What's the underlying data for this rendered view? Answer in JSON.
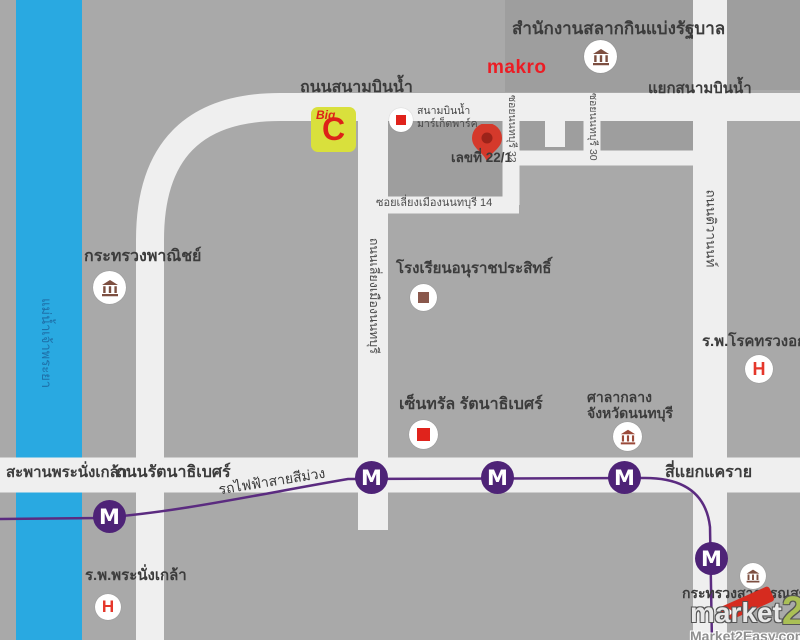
{
  "colors": {
    "background": "#a9a9a9",
    "block": "#9e9e9e",
    "road": "#efefef",
    "river_blue": "#29a9e1",
    "purple_line": "#5b2b80",
    "metro_badge": "#4e2377",
    "marker_red": "#e0231c",
    "icon_brown": "#7d4f41",
    "pin_red": "#d5392b",
    "bigc_yellow": "#d9e03c",
    "makro_red": "#ec1c24",
    "watermark_green": "#aabf55"
  },
  "river": {
    "name": "แม่น้ำเจ้าพระยา"
  },
  "roads": {
    "sanambinnam": "ถนนสนามบินน้ำ",
    "sanambinnam_junction": "แยกสนามบินน้ำ",
    "bypass": "ถนนเลี่ยงเมืองนนทบุรี",
    "tiwanon": "ถนนติวานนท์",
    "rattanathibet": "ถนนรัตนาธิเบศร์",
    "soi_nonthaburi_32": "ซอยนนทบุรี 32",
    "soi_nonthaburi_30": "ซอยนนทบุรี 30",
    "soi_liang_mueang_14": "ซอยเลี่ยงเมืองนนทบุรี 14",
    "khae_rai_intersection": "สี่แยกแคราย",
    "phra_nangklao_bridge": "สะพานพระนั่งเกล้า"
  },
  "transit": {
    "purple_line": "รถไฟฟ้าสายสีม่วง",
    "metro_letter": "M"
  },
  "places": {
    "lottery_office": "สำนักงานสลากกินแบ่งรัฐบาล",
    "makro": "makro",
    "big_c_big": "Big",
    "big_c_c": "C",
    "market_park_1": "สนามบินน้ำ",
    "market_park_2": "มาร์เก็ตพาร์ค",
    "address": "เลขที่ 22/1",
    "commerce_ministry": "กระทรวงพาณิชย์",
    "school": "โรงเรียนอนุราชประสิทธิ์",
    "central": "เซ็นทรัล รัตนาธิเบศร์",
    "city_hall_1": "ศาลากลาง",
    "city_hall_2": "จังหวัดนนทบุรี",
    "chest_hospital": "ร.พ.โรคทรวงอก",
    "pranangklao_hospital": "ร.พ.พระนั่งเกล้า",
    "health_ministry": "กระทรวงสาธารณสุข",
    "hospital_letter": "H"
  },
  "watermark": {
    "brand_market": "market",
    "brand_2": "2",
    "site": "Market2Easy.com"
  }
}
